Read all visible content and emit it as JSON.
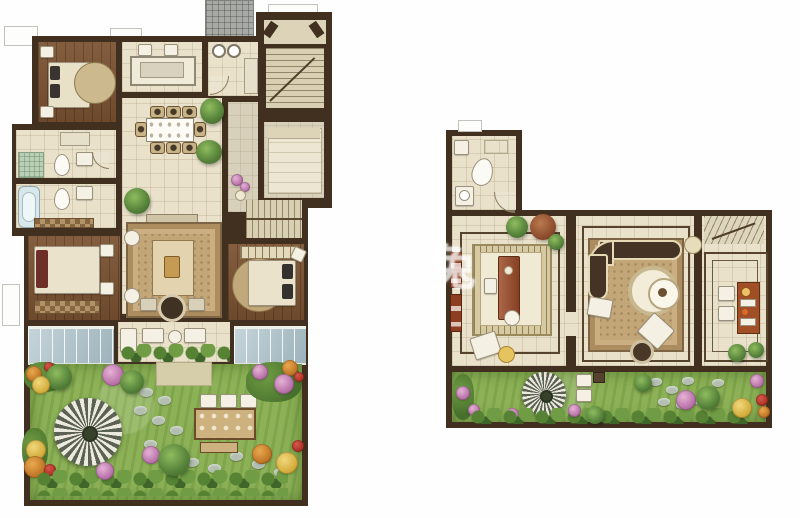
{
  "title": "Two-level residential floor plan with garden landscaping",
  "watermark": {
    "text": "兔"
  },
  "palette": {
    "wall": "#41301f",
    "floor_cream": "#e9e1ca",
    "floor_wood": "#7a5130",
    "floor_hall_beige": "#dcd3b8",
    "glass_blue": "#b3c6ce",
    "grass_green": "#8cb156",
    "rug_tan": "#c2a678",
    "parasol_light": "#eceadf",
    "parasol_dark": "#5c6253",
    "plant_green": "#55813a",
    "flower_pink": "#b66fa6",
    "flower_orange": "#c07425",
    "flower_yellow": "#d3ab3a",
    "flower_red": "#a82e22",
    "furniture_white": "#f4f0e4",
    "table_redwood": "#9c4c28",
    "hatch_gray": "#a8aba5",
    "tub_blue": "#d7e7ea"
  },
  "plans": {
    "left": {
      "rooms": [
        "bedroom-top-left",
        "kitchen",
        "bathroom-top",
        "stair-hall",
        "dining-room",
        "hallway",
        "bedroom-right-top",
        "bathroom-1",
        "bathroom-2",
        "bedroom-bottom-left",
        "living-room",
        "bedroom-bottom-right",
        "sunroom-left",
        "terrace",
        "sunroom-right",
        "garden"
      ],
      "garden_features": [
        "striped-parasol",
        "stepping-stones",
        "outdoor-dining-table",
        "bushes",
        "flowers",
        "trees"
      ]
    },
    "right": {
      "rooms": [
        "bathroom",
        "study-tatami-room",
        "lounge",
        "stairs",
        "bar-room",
        "garden-strip"
      ],
      "garden_features": [
        "striped-parasol",
        "stepping-stones",
        "bushes",
        "flowers",
        "trees"
      ]
    }
  }
}
